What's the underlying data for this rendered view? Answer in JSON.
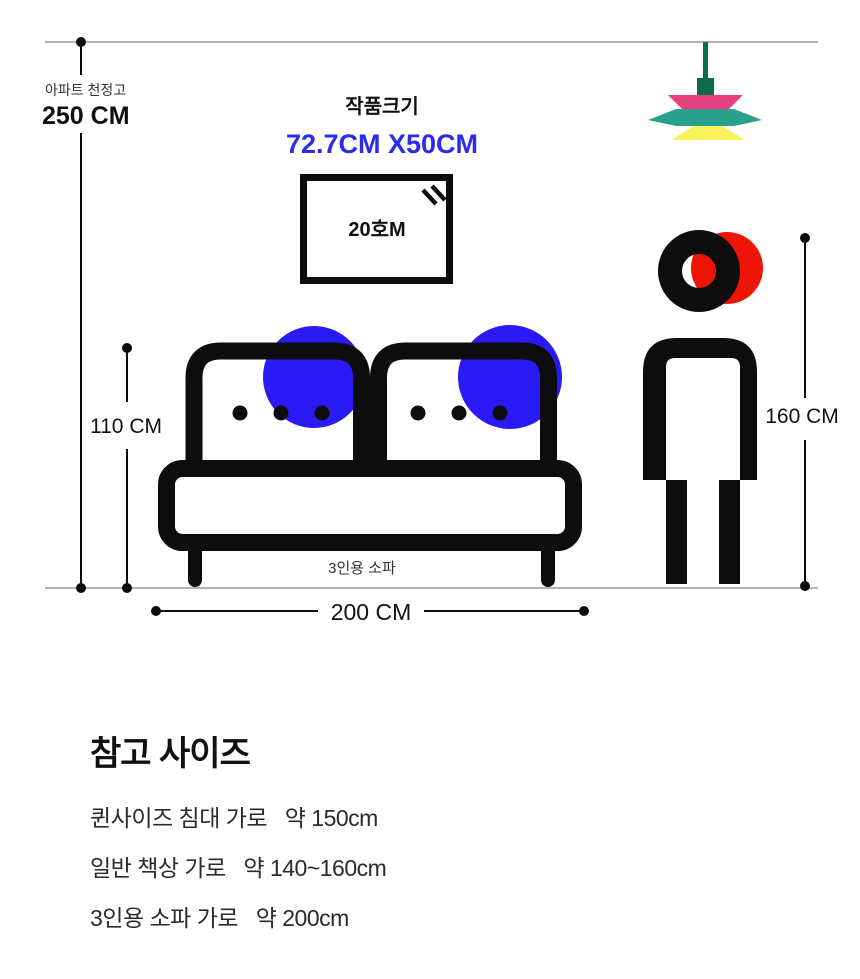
{
  "ceiling": {
    "label": "아파트 천정고",
    "value": "250 CM"
  },
  "artwork": {
    "title": "작품크기",
    "size": "72.7CM X50CM",
    "canvas_label": "20호M"
  },
  "measurements": {
    "sofa_height": "110 CM",
    "sofa_width": "200 CM",
    "person_height": "160 CM"
  },
  "sofa": {
    "label": "3인용 소파"
  },
  "reference": {
    "heading": "참고 사이즈",
    "items": [
      "퀸사이즈 침대 가로   약 150cm",
      "일반 책상 가로   약 140~160cm",
      "3인용 소파 가로   약 200cm"
    ]
  },
  "colors": {
    "accent_blue_text": "#2a2af0",
    "accent_blue_circle": "#2a1af5",
    "accent_red": "#ee1506",
    "lamp_pink": "#e8417f",
    "lamp_teal": "#2aa18c",
    "lamp_yellow": "#f8f35b",
    "lamp_green": "#0d6b47",
    "line_gray": "#b3b3b3",
    "ink": "#0d0d0d"
  }
}
